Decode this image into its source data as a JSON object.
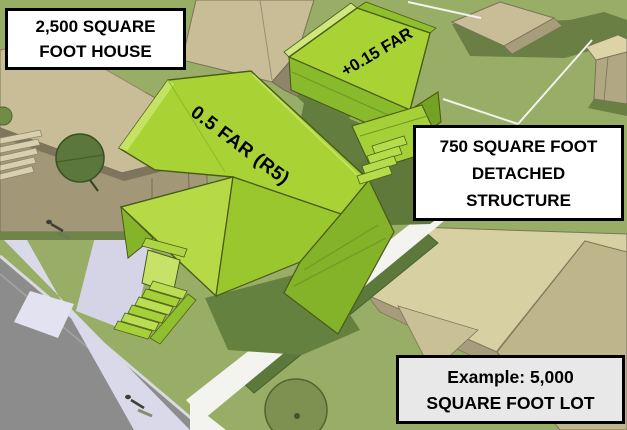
{
  "roof_labels": {
    "main_house_far": "0.5 FAR (R5)",
    "detached_far": "+0.15 FAR"
  },
  "callouts": {
    "house": {
      "line1": "2,500 SQUARE",
      "line2": "FOOT HOUSE"
    },
    "detached": {
      "line1": "750 SQUARE FOOT",
      "line2": "DETACHED",
      "line3": "STRUCTURE"
    },
    "example": {
      "line1": "Example: 5,000",
      "line2": "SQUARE FOOT LOT"
    }
  },
  "colors": {
    "highlight_green": "#a9d334",
    "highlight_green_light": "#c6e264",
    "highlight_green_dark": "#84b32a",
    "lawn_green": "#98ad65",
    "shadow_green": "#64803f",
    "neighbor_tan": "#c8bd96",
    "neighbor_roof_cream": "#d7d0a2",
    "road_gray": "#8c8c8c",
    "sidewalk_lavender": "#d9d9e9",
    "path_white": "#f3f3ef",
    "callout_bg": "#ffffff",
    "example_callout_bg": "#e8e8e8",
    "callout_border": "#000000",
    "label_text": "#000000"
  }
}
